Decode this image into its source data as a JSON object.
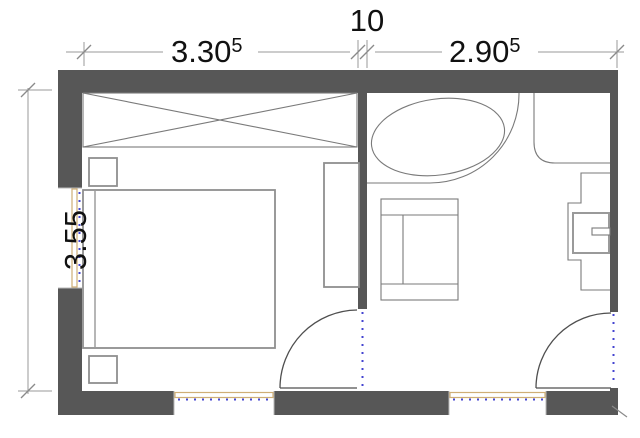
{
  "plan": {
    "colors": {
      "background": "#ffffff",
      "wall": "#575757",
      "furniture_line": "#8f8f8f",
      "fixture_line": "#7a7a7a",
      "door_line": "#4f4f4f",
      "window_frame": "#cfae76",
      "threshold_dash": "#4444d0",
      "dimension_line": "#9a9a9a",
      "text": "#111111"
    },
    "dimensions": {
      "top_left_value": "3.30",
      "top_left_sup": "5",
      "top_middle_value": "10",
      "top_right_value": "2.90",
      "top_right_sup": "5",
      "left_value": "3.55"
    }
  }
}
